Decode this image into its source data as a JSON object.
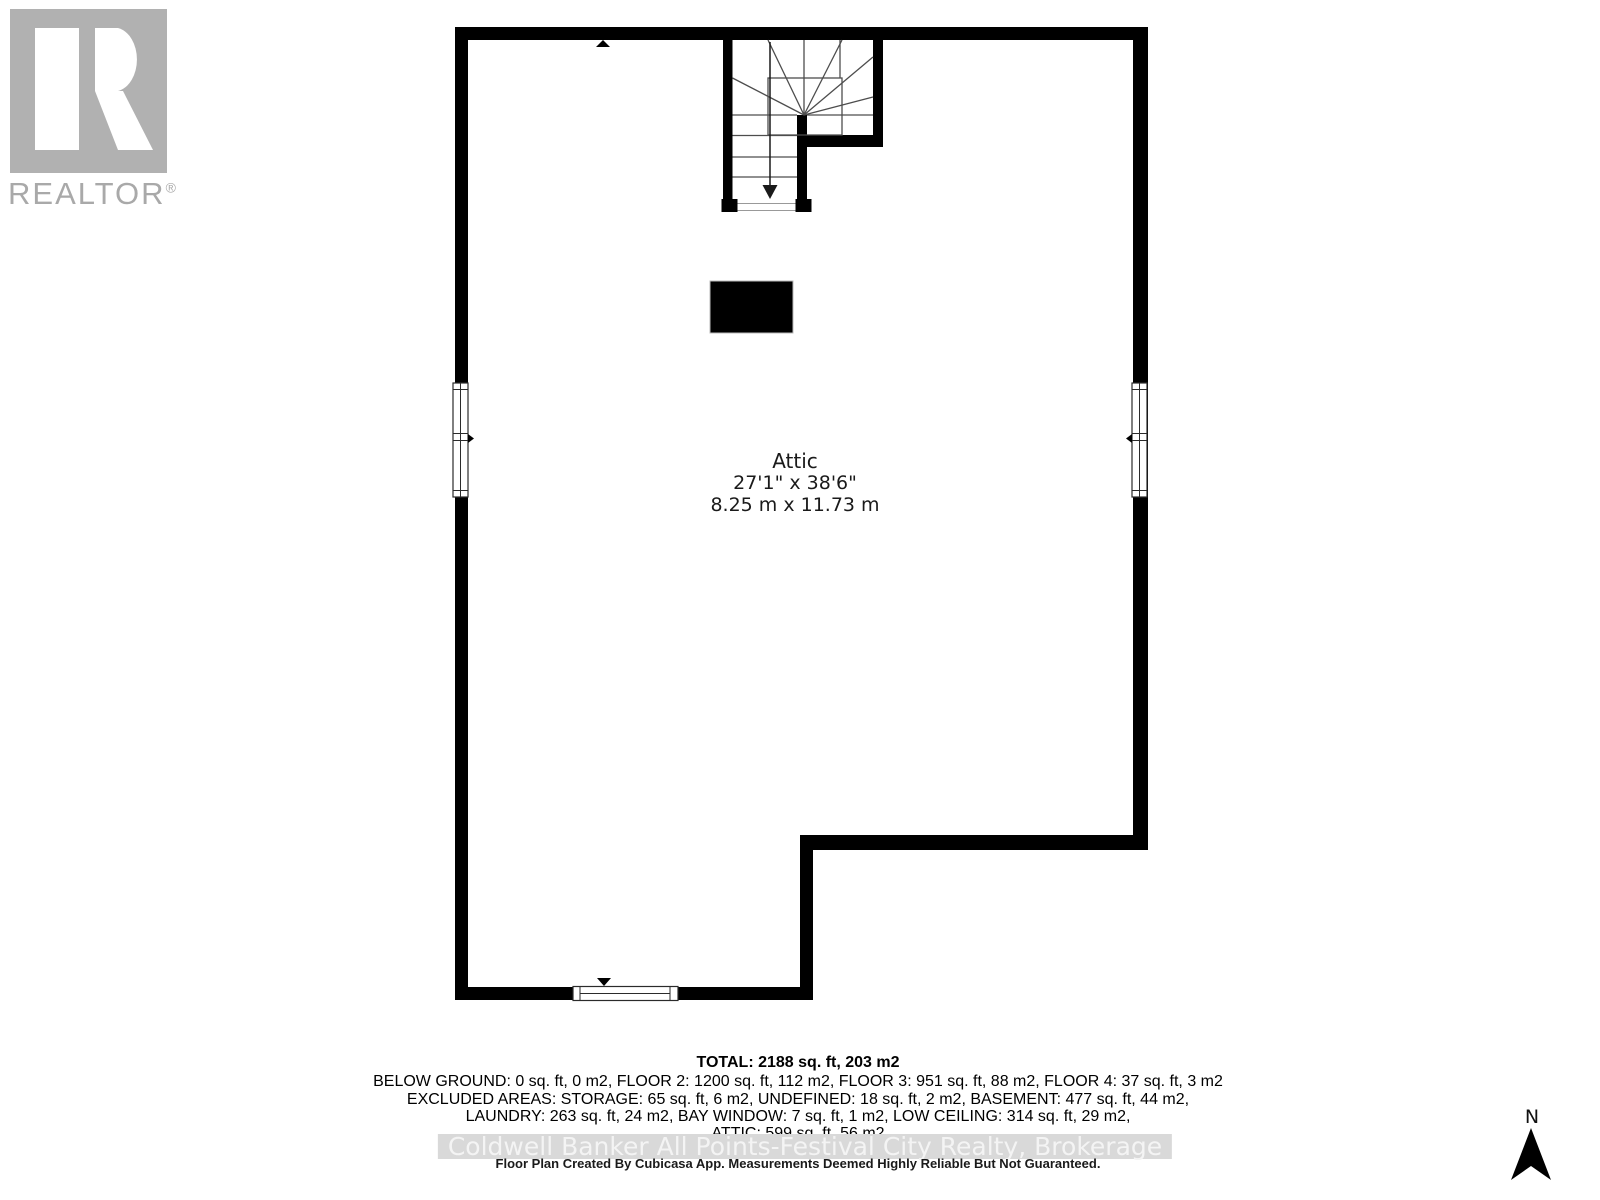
{
  "branding": {
    "logo_name": "REALTOR",
    "registered_symbol": "®",
    "logo_icon": "realtor-block-r-icon",
    "logo_color": "#b1b1b1",
    "logo_text_color": "#a9a9a9"
  },
  "plan": {
    "room": {
      "name": "Attic",
      "size_imperial": "27'1\" x 38'6\"",
      "size_metric": "8.25 m x 11.73 m"
    },
    "features": {
      "stairs": "winder-staircase-down",
      "windows": [
        "left-wall-window",
        "right-wall-window",
        "bottom-wall-window"
      ],
      "chimney": "solid-black-rectangle"
    },
    "compass": {
      "north_label": "N"
    },
    "wall_color": "#000000",
    "stair_line_color": "#4d4d4d"
  },
  "summary": {
    "total_line": "TOTAL: 2188 sq. ft, 203 m2",
    "lines": [
      "BELOW GROUND: 0 sq. ft, 0 m2, FLOOR 2: 1200 sq. ft, 112 m2, FLOOR 3: 951 sq. ft, 88 m2, FLOOR 4: 37 sq. ft, 3 m2",
      "EXCLUDED AREAS: STORAGE: 65 sq. ft, 6 m2, UNDEFINED: 18 sq. ft, 2 m2, BASEMENT: 477 sq. ft, 44 m2,",
      "LAUNDRY: 263 sq. ft, 24 m2, BAY WINDOW: 7 sq. ft, 1 m2, LOW CEILING: 314 sq. ft, 29 m2,",
      "ATTIC: 599 sq. ft, 56 m2"
    ]
  },
  "footer": {
    "watermark": "Coldwell Banker All Points-Festival City Realty, Brokerage",
    "watermark_band_color": "#d9d9d9",
    "watermark_text_color": "#f4f4f4",
    "disclaimer": "Floor Plan Created By Cubicasa App. Measurements Deemed Highly Reliable But Not Guaranteed."
  }
}
